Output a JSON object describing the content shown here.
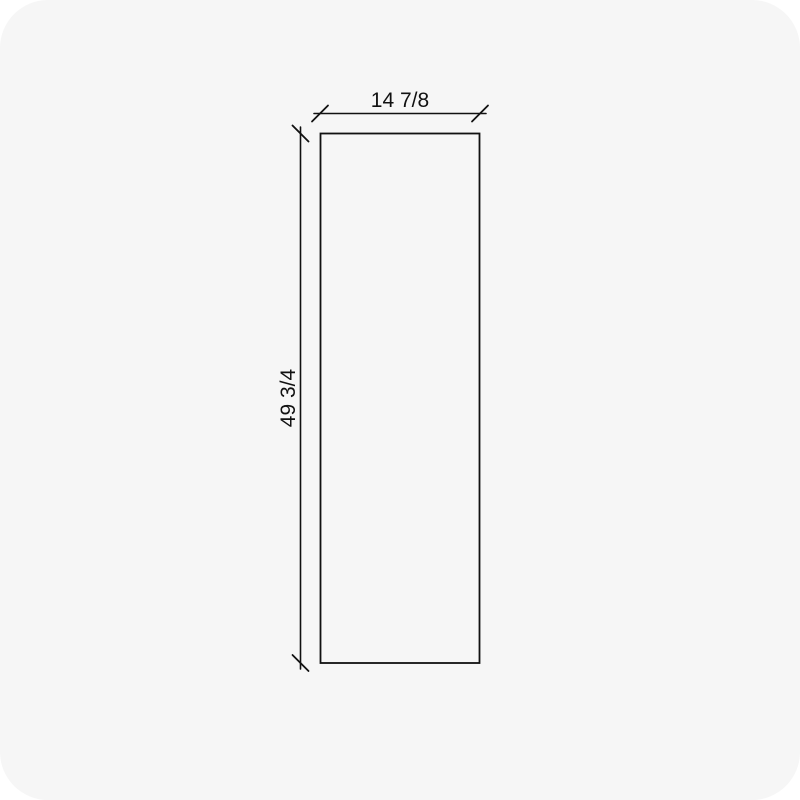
{
  "drawing": {
    "type": "panel-dimension-drawing",
    "width_label": "14 7/8",
    "height_label": "49 3/4"
  },
  "colors": {
    "canvas_background": "#f6f6f6",
    "page_background": "#ffffff",
    "line": "#111111",
    "text": "#111111"
  }
}
